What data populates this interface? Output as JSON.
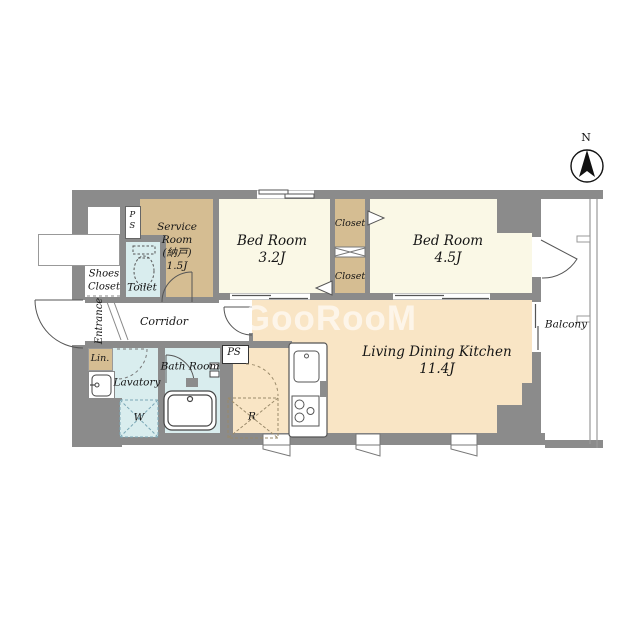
{
  "title": "apartment-floor-plan",
  "watermark": {
    "text": "GooRooM"
  },
  "compass": {
    "north": "N"
  },
  "rooms": {
    "service": {
      "l1": "Service",
      "l2": "Room",
      "l3": "(納戸)",
      "l4": "1.5J"
    },
    "bedroom_small": {
      "name": "Bed Room",
      "size": "3.2J"
    },
    "bedroom_large": {
      "name": "Bed Room",
      "size": "4.5J"
    },
    "ldk": {
      "name": "Living Dining Kitchen",
      "size": "11.4J"
    },
    "closet_top": "Closet",
    "closet_bottom": "Closet",
    "toilet": "Toilet",
    "bathroom": "Bath Room",
    "lavatory": "Lavatory",
    "linen": "Lin.",
    "shoes": {
      "l1": "Shoes",
      "l2": "Closet"
    },
    "entrance": "Entrance",
    "corridor": "Corridor",
    "balcony": "Balcony",
    "washer_space": "W",
    "fridge_space": "R",
    "ps_top": "PS",
    "ps_kitchen": "PS"
  },
  "colors": {
    "wall": "#8b8b8b",
    "bedroom": "#faf8e6",
    "storage_tan": "#d5bd92",
    "ldk_peach": "#f9e5c5",
    "wet_blue": "#d9edee"
  }
}
